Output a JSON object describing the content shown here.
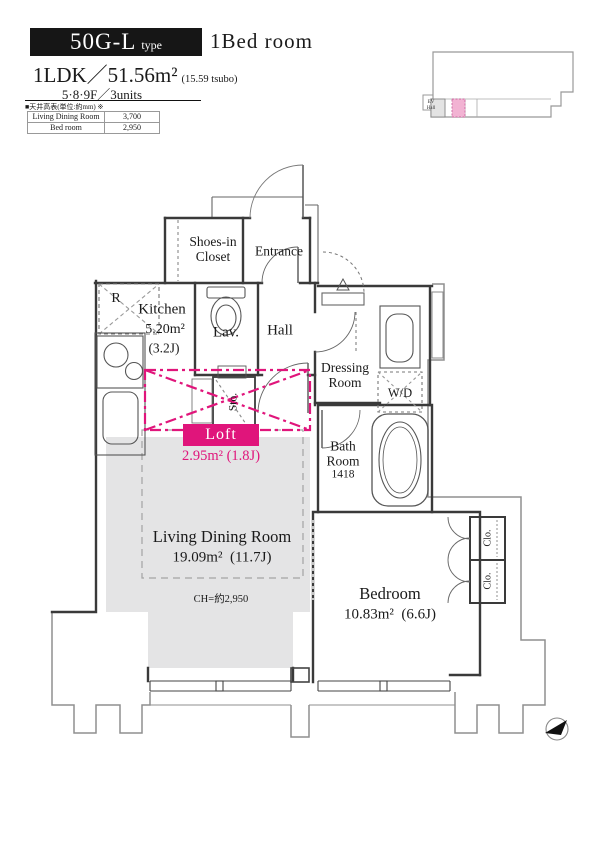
{
  "title_block": {
    "type_code": "50G-L",
    "type_label": "type",
    "category": "1Bed room",
    "spec_main": "1LDK／51.56m²",
    "spec_tsubo": "(15.59 tsubo)",
    "spec_floors": "5·8·9F／3units"
  },
  "ceiling_table": {
    "title": "■天井高表(単位:約mm) ※",
    "rows": [
      {
        "label": "Living Dining Room",
        "value": "3,700"
      },
      {
        "label": "Bed room",
        "value": "2,950"
      }
    ]
  },
  "key_plan": {
    "ev_line1": "EV",
    "ev_line2": "Hall"
  },
  "rooms": {
    "shoes_closet_line1": "Shoes-in",
    "shoes_closet_line2": "Closet",
    "entrance": "Entrance",
    "fridge": "R",
    "kitchen_name": "Kitchen",
    "kitchen_area": "5.20m²",
    "kitchen_jo": "(3.2J)",
    "lavatory": "Lav.",
    "hall": "Hall",
    "dressing_line1": "Dressing",
    "dressing_line2": "Room",
    "washer_dryer": "W/D",
    "bath_line1": "Bath",
    "bath_line2": "Room",
    "bath_size": "1418",
    "storage": "Sto.",
    "loft_name": "Loft",
    "loft_area": "2.95m²",
    "loft_jo": "(1.8J)",
    "ldk_name": "Living Dining Room",
    "ldk_area": "19.09m²",
    "ldk_jo": "(11.7J)",
    "ldk_ceiling": "CH=約2,950",
    "bedroom_name": "Bedroom",
    "bedroom_area": "10.83m²",
    "bedroom_jo": "(6.6J)",
    "closet_upper": "Clo.",
    "closet_lower": "Clo."
  },
  "colors": {
    "accent_pink": "#e0157b",
    "keyplan_unit_pink": "#f2b3d3",
    "floor_gray": "#e4e4e5",
    "wall": "#3a3a3a"
  }
}
